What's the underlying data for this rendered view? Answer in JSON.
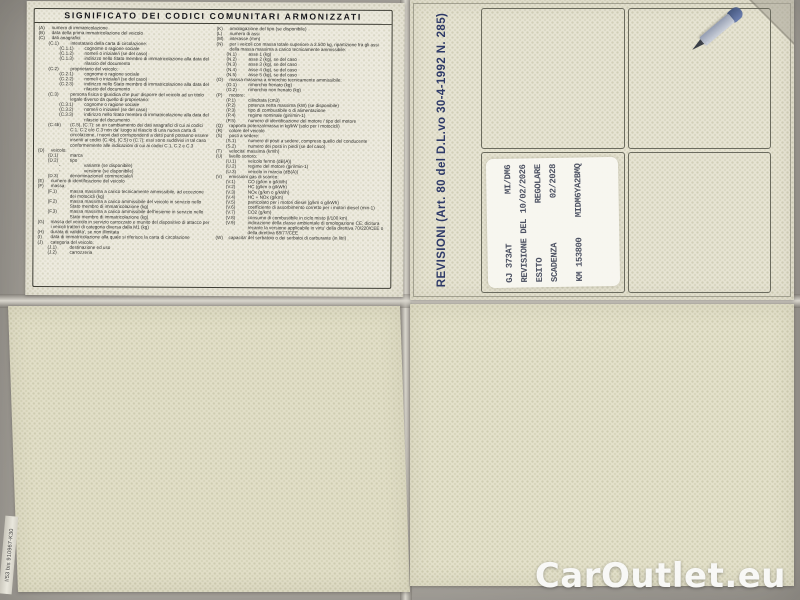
{
  "photo": {
    "watermark": "CarOutlet.eu",
    "edge_code": "I/53 bis 910967-K30"
  },
  "colors": {
    "background_gray": "#aca8a1",
    "paper_cream": "#e8e5d4",
    "paper_blank": "#e2dfc8",
    "legend_ink": "#2b2b28",
    "revision_blue": "#2e3a68",
    "stamp_ink": "#4d5263",
    "watermark_white": "#f8f8f6"
  },
  "legend_panel": {
    "title": "SIGNIFICATO DEI CODICI COMUNITARI ARMONIZZATI",
    "left_column": [
      {
        "code": "(A)",
        "text": "numero di immatricolazione",
        "level": 0
      },
      {
        "code": "(B)",
        "text": "data della prima immatricolazione del veicolo",
        "level": 0
      },
      {
        "code": "(C)",
        "text": "dati anagrafici:",
        "level": 0
      },
      {
        "code": "(C.1)",
        "text": "intestatario della carta di circolazione:",
        "level": 1
      },
      {
        "code": "(C.1.1)",
        "text": "cognome o ragione sociale",
        "level": 2
      },
      {
        "code": "(C.1.2)",
        "text": "nome/i o iniziale/i (se del caso)",
        "level": 2
      },
      {
        "code": "(C.1.3)",
        "text": "indirizzo nello Stato membro di immatricolazione alla data del rilascio del documento",
        "level": 2
      },
      {
        "code": "(C.2)",
        "text": "proprietario del veicolo:",
        "level": 1
      },
      {
        "code": "(C.2.1)",
        "text": "cognome o ragione sociale",
        "level": 2
      },
      {
        "code": "(C.2.2)",
        "text": "nome/i o iniziale/i (se del caso)",
        "level": 2
      },
      {
        "code": "(C.2.3)",
        "text": "indirizzo nello Stato membro di immatricolazione alla data del rilascio del documento",
        "level": 2
      },
      {
        "code": "(C.3)",
        "text": "persona fisica o giuridica che puo' disporre del veicolo ad un titolo legale diverso da quello di proprietario:",
        "level": 1
      },
      {
        "code": "(C.3.1)",
        "text": "cognome o ragione sociale",
        "level": 2
      },
      {
        "code": "(C.3.2)",
        "text": "nome/i o iniziale/i (se del caso)",
        "level": 2
      },
      {
        "code": "(C.3.3)",
        "text": "indirizzo nello Stato membro di immatricolazione alla data del rilascio del documento",
        "level": 2
      },
      {
        "code": "(C.4b)",
        "text": "(C.5), (C.7): se un cambiamento dei dati anagrafici di cui ai codici C.1, C.2 e/o C.3 non da' luogo al rilascio di una nuova carta di circolazione, i nuovi dati corrispondenti a detti punti potranno essere inseriti ai codici (C.4b), (C.5) o (C.7); essi sono suddivisi in tal caso conformemente alle indicazioni di cui ai codici C.1, C.2 e C.3",
        "level": 1
      },
      {
        "code": "(D)",
        "text": "veicolo:",
        "level": 0
      },
      {
        "code": "(D.1)",
        "text": "marca",
        "level": 1
      },
      {
        "code": "(D.2)",
        "text": "tipo",
        "level": 1
      },
      {
        "code": "-",
        "text": "variante (se disponibile)",
        "level": 2
      },
      {
        "code": "-",
        "text": "versione (se disponibile)",
        "level": 2
      },
      {
        "code": "(D.3)",
        "text": "denominazione/i commerciale/i",
        "level": 1
      },
      {
        "code": "(E)",
        "text": "numero di identificazione del veicolo",
        "level": 0
      },
      {
        "code": "(F)",
        "text": "massa:",
        "level": 0
      },
      {
        "code": "(F.1)",
        "text": "massa massima a carico tecnicamente ammissibile, ad eccezione dei motocicli (kg)",
        "level": 1
      },
      {
        "code": "(F.2)",
        "text": "massa massima a carico ammissibile del veicolo in servizio nello Stato membro di immatricolazione (kg)",
        "level": 1
      },
      {
        "code": "(F.3)",
        "text": "massa massima a carico ammissibile dell'insieme in servizio nello Stato membro di immatricolazione (kg)",
        "level": 1
      },
      {
        "code": "(G)",
        "text": "massa del veicolo in servizio carrozzato e munito del dispositivo di attacco per i veicoli trattori di categoria diversa dalla M1 (kg)",
        "level": 0
      },
      {
        "code": "(H)",
        "text": "durata di validita', se non illimitata",
        "level": 0
      },
      {
        "code": "(I)",
        "text": "data di immatricolazione alla quale si riferisce la carta di circolazione",
        "level": 0
      },
      {
        "code": "(J)",
        "text": "categoria del veicolo:",
        "level": 0
      },
      {
        "code": "(J.1)",
        "text": "destinazione ed uso",
        "level": 1
      },
      {
        "code": "(J.2)",
        "text": "carrozzeria",
        "level": 1
      }
    ],
    "right_column": [
      {
        "code": "(K)",
        "text": "omologazione del tipo (se disponibile)",
        "level": 0
      },
      {
        "code": "(L)",
        "text": "numero di assi",
        "level": 0
      },
      {
        "code": "(M)",
        "text": "interasse (mm)",
        "level": 0
      },
      {
        "code": "(N)",
        "text": "per i veicoli con massa totale superiore a 3.500 kg, ripartizione fra gli assi della massa massima a carico tecnicamente ammissibile:",
        "level": 0
      },
      {
        "code": "(N.1)",
        "text": "asse 1 (kg)",
        "level": 1
      },
      {
        "code": "(N.2)",
        "text": "asse 2 (kg), se del caso",
        "level": 1
      },
      {
        "code": "(N.3)",
        "text": "asse 3 (kg), se del caso",
        "level": 1
      },
      {
        "code": "(N.4)",
        "text": "asse 4 (kg), se del caso",
        "level": 1
      },
      {
        "code": "(N.5)",
        "text": "asse 5 (kg), se del caso",
        "level": 1
      },
      {
        "code": "(O)",
        "text": "massa massima a rimorchio tecnicamente ammissibile:",
        "level": 0
      },
      {
        "code": "(O.1)",
        "text": "rimorchio frenato (kg)",
        "level": 1
      },
      {
        "code": "(O.2)",
        "text": "rimorchio non frenato (kg)",
        "level": 1
      },
      {
        "code": "(P)",
        "text": "motore:",
        "level": 0
      },
      {
        "code": "(P.1)",
        "text": "cilindrata (cm3)",
        "level": 1
      },
      {
        "code": "(P.2)",
        "text": "potenza netta massima (kW) (se disponibile)",
        "level": 1
      },
      {
        "code": "(P.3)",
        "text": "tipo di combustibile o di alimentazione",
        "level": 1
      },
      {
        "code": "(P.4)",
        "text": "regime nominale (giri/min-1)",
        "level": 1
      },
      {
        "code": "(P.5)",
        "text": "numero di identificazione del motore / tipo del motore",
        "level": 1
      },
      {
        "code": "(Q)",
        "text": "rapporto potenza/massa in kg/kW (solo per i motocicli)",
        "level": 0
      },
      {
        "code": "(R)",
        "text": "colore del veicolo",
        "level": 0
      },
      {
        "code": "(S)",
        "text": "posti a sedere:",
        "level": 0
      },
      {
        "code": "(S.1)",
        "text": "numero di posti a sedere, compreso quello del conducente",
        "level": 1
      },
      {
        "code": "(S.2)",
        "text": "numero dei posti in piedi (se del caso)",
        "level": 1
      },
      {
        "code": "(T)",
        "text": "velocita' massima (km/h)",
        "level": 0
      },
      {
        "code": "(U)",
        "text": "livello sonoro:",
        "level": 0
      },
      {
        "code": "(U.1)",
        "text": "veicolo fermo (dB(A))",
        "level": 1
      },
      {
        "code": "(U.2)",
        "text": "regime del motore (giri/min-1)",
        "level": 1
      },
      {
        "code": "(U.3)",
        "text": "veicolo in marcia (dB(A))",
        "level": 1
      },
      {
        "code": "(V)",
        "text": "emissioni gas di scarico:",
        "level": 0
      },
      {
        "code": "(V.1)",
        "text": "CO (g/km o g/kWh)",
        "level": 1
      },
      {
        "code": "(V.2)",
        "text": "HC (g/km o g/kWh)",
        "level": 1
      },
      {
        "code": "(V.3)",
        "text": "NOx (g/km o g/kWh)",
        "level": 1
      },
      {
        "code": "(V.4)",
        "text": "HC + NOx (g/km)",
        "level": 1
      },
      {
        "code": "(V.5)",
        "text": "particolato per i motori diesel (g/km o g/kWh)",
        "level": 1
      },
      {
        "code": "(V.6)",
        "text": "coefficiente di assorbimento corretto per i motori diesel (min-1)",
        "level": 1
      },
      {
        "code": "(V.7)",
        "text": "CO2 (g/km)",
        "level": 1
      },
      {
        "code": "(V.8)",
        "text": "consumo di combustibile in ciclo misto (l/100 km)",
        "level": 1
      },
      {
        "code": "(V.9)",
        "text": "indicazione della classe ambientale di omologazione CE: dicitura recante la versione applicabile in virtu' della direttiva 70/220/CEE o della direttiva 88/77/CEE",
        "level": 1
      },
      {
        "code": "(W)",
        "text": "capacita' del serbatoio o dei serbatoi di carburante (in litri)",
        "level": 0
      }
    ]
  },
  "revision_panel": {
    "side_label": "REVISIONI (Art. 80 del D.L.vo 30-4-1992 N. 285)",
    "stamp": {
      "lines": [
        {
          "left": "GJ 373AT",
          "right": "MI/DM6",
          "gap_before": false
        },
        {
          "left": "REVISIONE DEL",
          "right": "10/02/2026",
          "gap_before": false
        },
        {
          "left": "ESITO",
          "right": "REGOLARE",
          "gap_before": false
        },
        {
          "left": "SCADENZA",
          "right": "02/2028",
          "gap_before": false
        },
        {
          "left": "KM 153800",
          "right": "MIDM6YA2BMQ",
          "gap_before": true
        }
      ]
    }
  }
}
